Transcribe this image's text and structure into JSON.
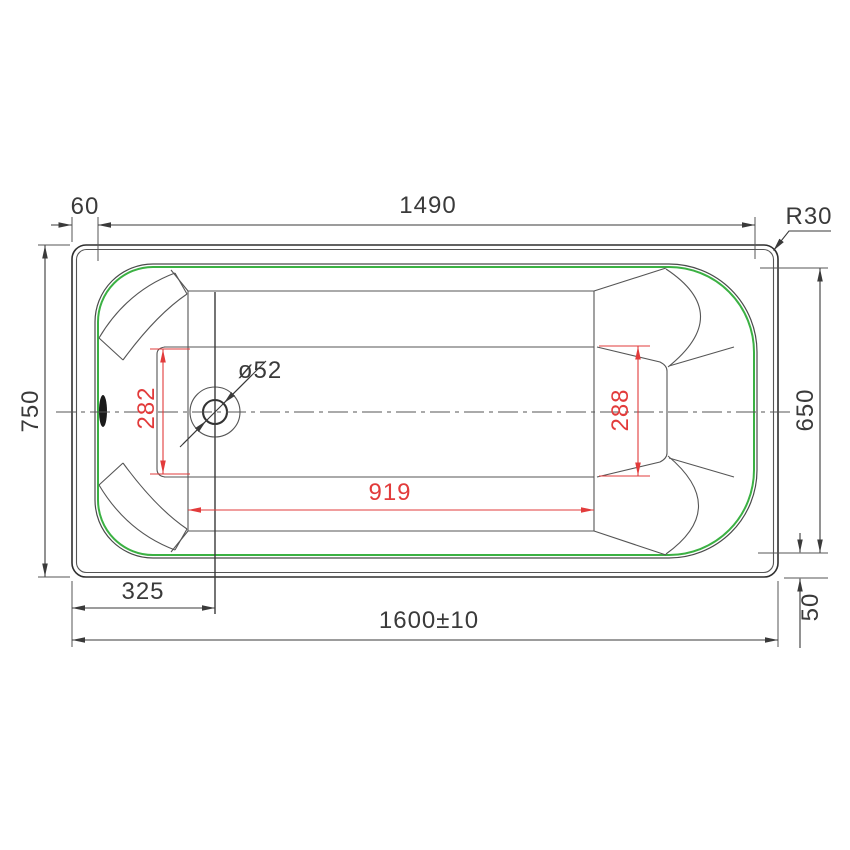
{
  "drawing": {
    "type": "technical-drawing",
    "subject": "bathtub-top-view",
    "colors": {
      "line": "#3a3a3a",
      "thin_line": "#555555",
      "rim_highlight_green": "#3bb143",
      "dimension_red": "#e23b3b",
      "background": "#ffffff"
    },
    "dimensions": {
      "rim_offset_top": "60",
      "inner_length_top": "1490",
      "corner_radius": "R30",
      "overall_width": "750",
      "inner_width": "650",
      "bottom_width_at_drain": "282",
      "bottom_width_at_back": "288",
      "drain_diameter": "ø52",
      "bottom_length": "919",
      "drain_offset": "325",
      "overall_length": "1600±10",
      "rim_drop_side": "50"
    }
  }
}
